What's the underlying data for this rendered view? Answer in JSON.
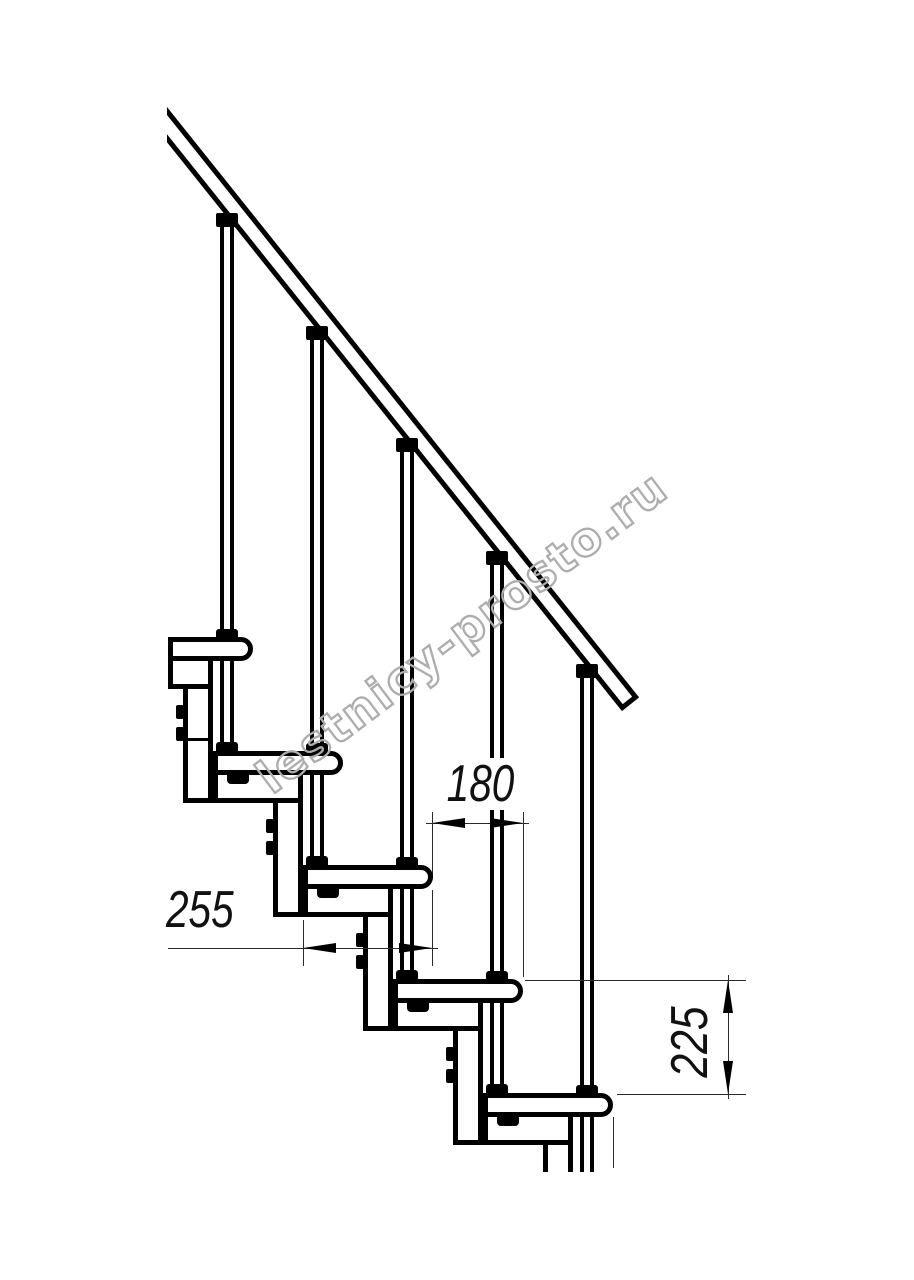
{
  "watermark": "lestnicy-prosto.ru",
  "dimensions": {
    "tread_length_label": "255",
    "run_label": "180",
    "rise_label": "225"
  },
  "colors": {
    "line": "#000000",
    "thin_line": "#2b2b2b",
    "watermark_stroke": "#adadad",
    "background": "#ffffff"
  }
}
